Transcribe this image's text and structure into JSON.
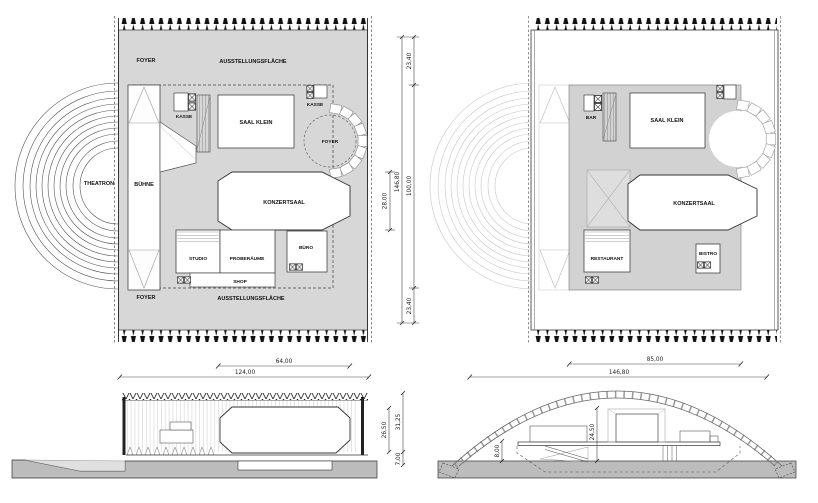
{
  "plan_left": {
    "labels": {
      "foyer_top": "FOYER",
      "exhibition_top": "AUSSTELLUNGSFLÄCHE",
      "theatron": "THEATRON",
      "buehne": "BÜHNE",
      "kasse_left": "KASSE",
      "saal_klein": "SAAL KLEIN",
      "kasse_right": "KASSE",
      "foyer_round": "FOYER",
      "konzertsaal": "KONZERTSAAL",
      "studio": "STUDIO",
      "proberaeume": "PROBERÄUME",
      "buero": "BÜRO",
      "shop": "SHOP",
      "foyer_bottom": "FOYER",
      "exhibition_bottom": "AUSSTELLUNGSFLÄCHE"
    },
    "dims": {
      "seg_top": "23,40",
      "seg_mid": "100,00",
      "seg_bottom": "23,40",
      "total_height": "146,80",
      "hall_height": "28,00",
      "inner_width": "64,00",
      "total_width": "124,00"
    }
  },
  "plan_right": {
    "labels": {
      "bar": "BAR",
      "saal_klein": "SAAL KLEIN",
      "konzertsaal": "KONZERTSAAL",
      "restaurant": "RESTAURANT",
      "bistro": "BISTRO"
    },
    "dims": {
      "inner_width": "85,00",
      "total_width": "146,80"
    }
  },
  "section_left": {
    "dims": {
      "above_ground": "26,50",
      "total_height": "31,25",
      "below_ground": "7,00"
    }
  },
  "section_right": {
    "dims": {
      "inner_height": "24,50",
      "base_height": "8,00"
    }
  }
}
